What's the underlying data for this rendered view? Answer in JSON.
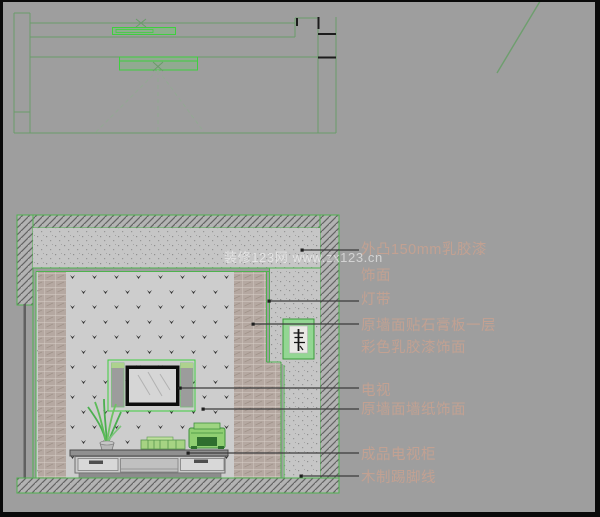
{
  "watermark": {
    "text": "装修123网 www.zx123.cn"
  },
  "labels": [
    {
      "id": "protruding-finish",
      "text": "外凸150mm乳胶漆饰面"
    },
    {
      "id": "light-strip",
      "text": "灯带"
    },
    {
      "id": "gypsum-board",
      "text": "原墙面贴石膏板一层彩色乳胶漆饰面"
    },
    {
      "id": "tv",
      "text": "电视"
    },
    {
      "id": "wallpaper",
      "text": "原墙面墙纸饰面"
    },
    {
      "id": "tv-cabinet",
      "text": "成品电视柜"
    },
    {
      "id": "skirting",
      "text": "木制踢脚线"
    }
  ],
  "colors": {
    "background": "#9e9e9e",
    "cad_green_bright": "#3fcf3f",
    "cad_green_outline": "#4fb24f",
    "plan_line_green": "#6a9c6a",
    "annotation_text": "#c2a192",
    "leader_line": "#3c3c3c"
  }
}
